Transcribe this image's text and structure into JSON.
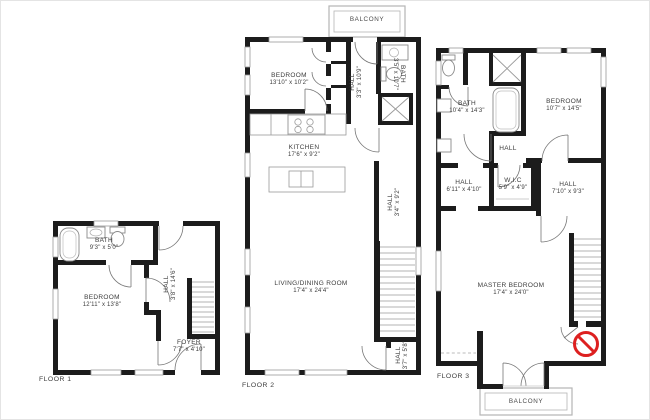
{
  "title": "3-floor apartment floor plan",
  "colors": {
    "wall": "#1c1c1c",
    "text": "#3c3c3c",
    "window_stroke": "#9a9a9a",
    "fixture_stroke": "#8a8a8a",
    "balcony_outline": "#b5b5b5",
    "stair_stroke": "#9b9b9b",
    "door_stroke": "#777777",
    "no_entry": "#dd2020"
  },
  "floors": [
    {
      "label": "FLOOR 1",
      "rooms": [
        {
          "name": "BATH",
          "dims": "9'3\" x 5'0\""
        },
        {
          "name": "BEDROOM",
          "dims": "12'11\" x 13'8\""
        },
        {
          "name": "HALL",
          "dims": "3'8\" x 14'6\""
        },
        {
          "name": "FOYER",
          "dims": "7'7\" x 4'10\""
        }
      ]
    },
    {
      "label": "FLOOR 2",
      "balcony": "BALCONY",
      "rooms": [
        {
          "name": "BEDROOM",
          "dims": "13'10\" x 10'2\""
        },
        {
          "name": "HALL",
          "dims": "3'3\" x 10'9\""
        },
        {
          "name": "BATH",
          "dims": "3'5\" x 10'7\""
        },
        {
          "name": "KITCHEN",
          "dims": "17'6\" x 9'2\""
        },
        {
          "name": "HALL",
          "dims": "3'4\" x 9'2\""
        },
        {
          "name": "LIVING/DINING ROOM",
          "dims": "17'4\" x 24'4\""
        },
        {
          "name": "HALL",
          "dims": "3'7\" x 5'8\""
        }
      ]
    },
    {
      "label": "FLOOR 3",
      "balcony": "BALCONY",
      "rooms": [
        {
          "name": "BATH",
          "dims": "10'4\" x 14'3\""
        },
        {
          "name": "BEDROOM",
          "dims": "10'7\" x 14'5\""
        },
        {
          "name": "HALL",
          "dims": ""
        },
        {
          "name": "HALL",
          "dims": "6'11\" x 4'10\""
        },
        {
          "name": "W.I.C",
          "dims": "5'9\" x 4'9\""
        },
        {
          "name": "HALL",
          "dims": "7'10\" x 9'3\""
        },
        {
          "name": "MASTER BEDROOM",
          "dims": "17'4\" x 24'0\""
        }
      ]
    }
  ]
}
